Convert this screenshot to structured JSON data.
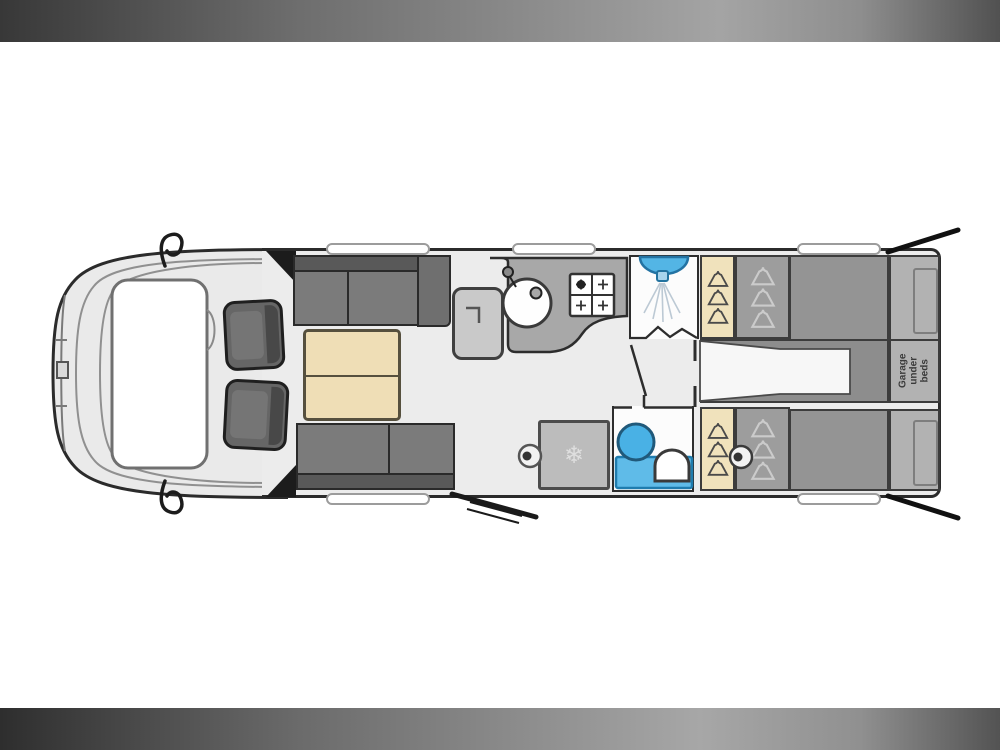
{
  "floorplan": {
    "title": "Motorhome floor plan (top view)",
    "labels": {
      "garage": "Garage under beds"
    },
    "icons": {
      "snowflake": "❄",
      "names": [
        "hanger-icon",
        "snowflake-icon",
        "sink-icon",
        "hob-icon",
        "shower-head-icon",
        "toilet-icon",
        "basin-icon"
      ]
    },
    "zones": [
      "cab-with-swivel-seats",
      "lounge-with-sofas",
      "dinette-table",
      "tv-cabinet",
      "kitchen-sink-and-hob",
      "fridge",
      "shower-cubicle",
      "washroom-toilet",
      "wardrobes",
      "corridor",
      "twin-single-beds",
      "rear-garage-under-beds",
      "entry-door"
    ],
    "colors": {
      "background": "#ffffff",
      "letterbox_dark": "#2e2e2e",
      "letterbox_light": "#a7a7a7",
      "floor": "#ececec",
      "outline": "#2b2b2b",
      "upholstery": "#7b7b7b",
      "upholstery_dark": "#595959",
      "wood_tan": "#efdeb6",
      "wardrobe_tan": "#f0e2bc",
      "worktop_gray": "#a8a8a8",
      "bed_gray": "#949494",
      "headboard_gray": "#b2b2b2",
      "water_blue": "#53b5e5",
      "water_blue_dark": "#1f7cae"
    }
  }
}
